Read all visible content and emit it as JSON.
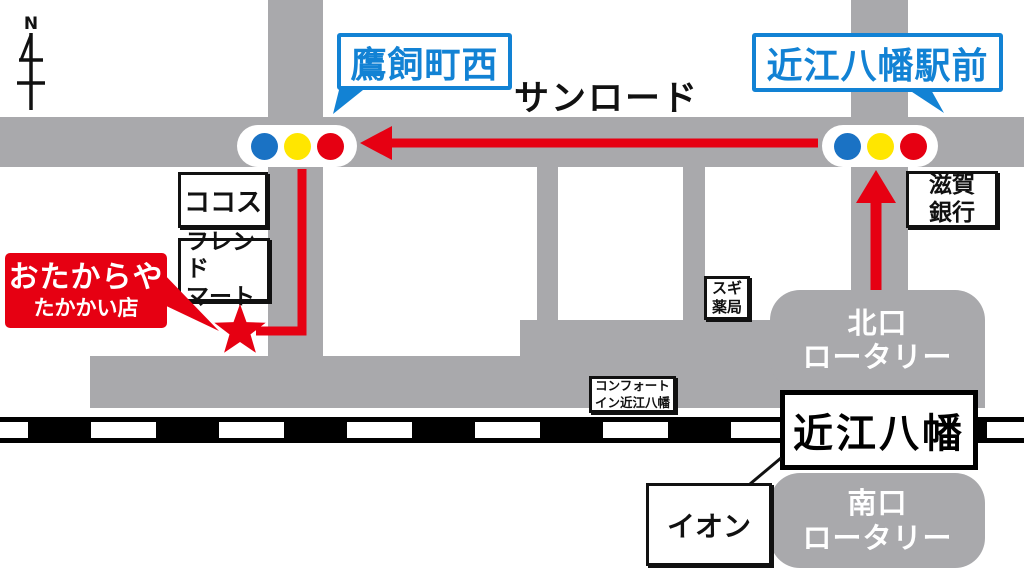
{
  "colors": {
    "road_gray": "#a9a9ac",
    "accent_blue": "#1282d4",
    "accent_red": "#e60012",
    "signal_blue": "#1a72c4",
    "signal_yellow": "#ffe600",
    "railway_black": "#000000"
  },
  "compass": {
    "label": "N"
  },
  "street": {
    "name": "サンロード"
  },
  "signals": {
    "west": {
      "label": "鷹飼町西"
    },
    "east": {
      "label": "近江八幡駅前"
    }
  },
  "store": {
    "name": "おたからや",
    "branch": "たかかい店"
  },
  "landmarks": {
    "cocos": "ココス",
    "friend_mart": "フレンド\nマート",
    "sugi_pharmacy": "スギ\n薬局",
    "shiga_bank": "滋賀\n銀行",
    "comfort_inn": "コンフォート\nイン近江八幡",
    "aeon": "イオン"
  },
  "station": {
    "name": "近江八幡"
  },
  "rotaries": {
    "north": "北口\nロータリー",
    "south": "南口\nロータリー"
  }
}
